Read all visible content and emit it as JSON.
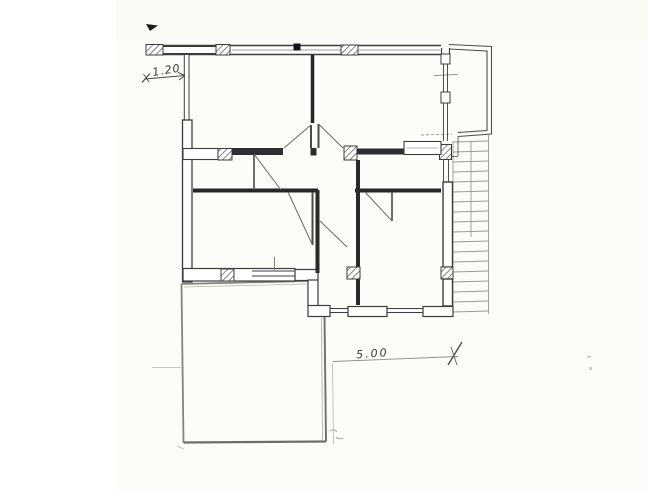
{
  "document": {
    "kind": "scanned hand-drawn floor plan",
    "annotations": {
      "window_width_label": "1.20",
      "plan_width_label": "5.00"
    },
    "colors": {
      "paper": "#fcfcf9",
      "ink": "#3c3c3c",
      "ink_dark": "#262626",
      "pencil": "#8b8b83",
      "faint": "#b9b9b1",
      "hatch": "#555550"
    }
  }
}
